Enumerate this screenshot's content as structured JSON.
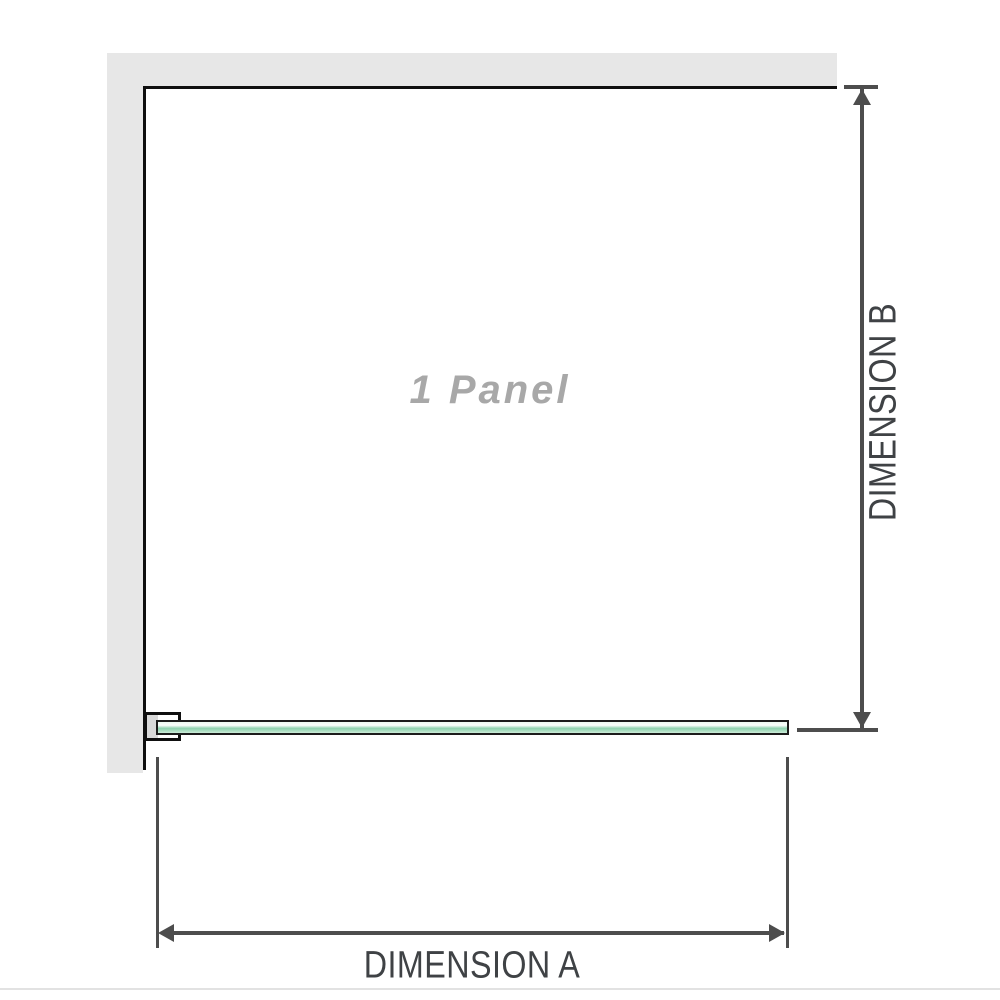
{
  "theme": {
    "wall-fill": "#e7e7e7",
    "wall-line": "#0f0f0f",
    "dim-line": "#4d4d4d",
    "dim-text": "#3f4245",
    "panel-text": "#a8a8a8",
    "glass-border": "#1c1c1c",
    "glass-light": "#eef9f2",
    "glass-mid": "#8fd2af",
    "glass-soft": "#cdecd9",
    "bracket-fill": "#d9d9d9",
    "page-rule": "#e2e2e2"
  },
  "diagram": {
    "panel_label": "1 Panel",
    "dimension_a": {
      "label": "DIMENSION A"
    },
    "dimension_b": {
      "label": "DIMENSION B"
    }
  }
}
